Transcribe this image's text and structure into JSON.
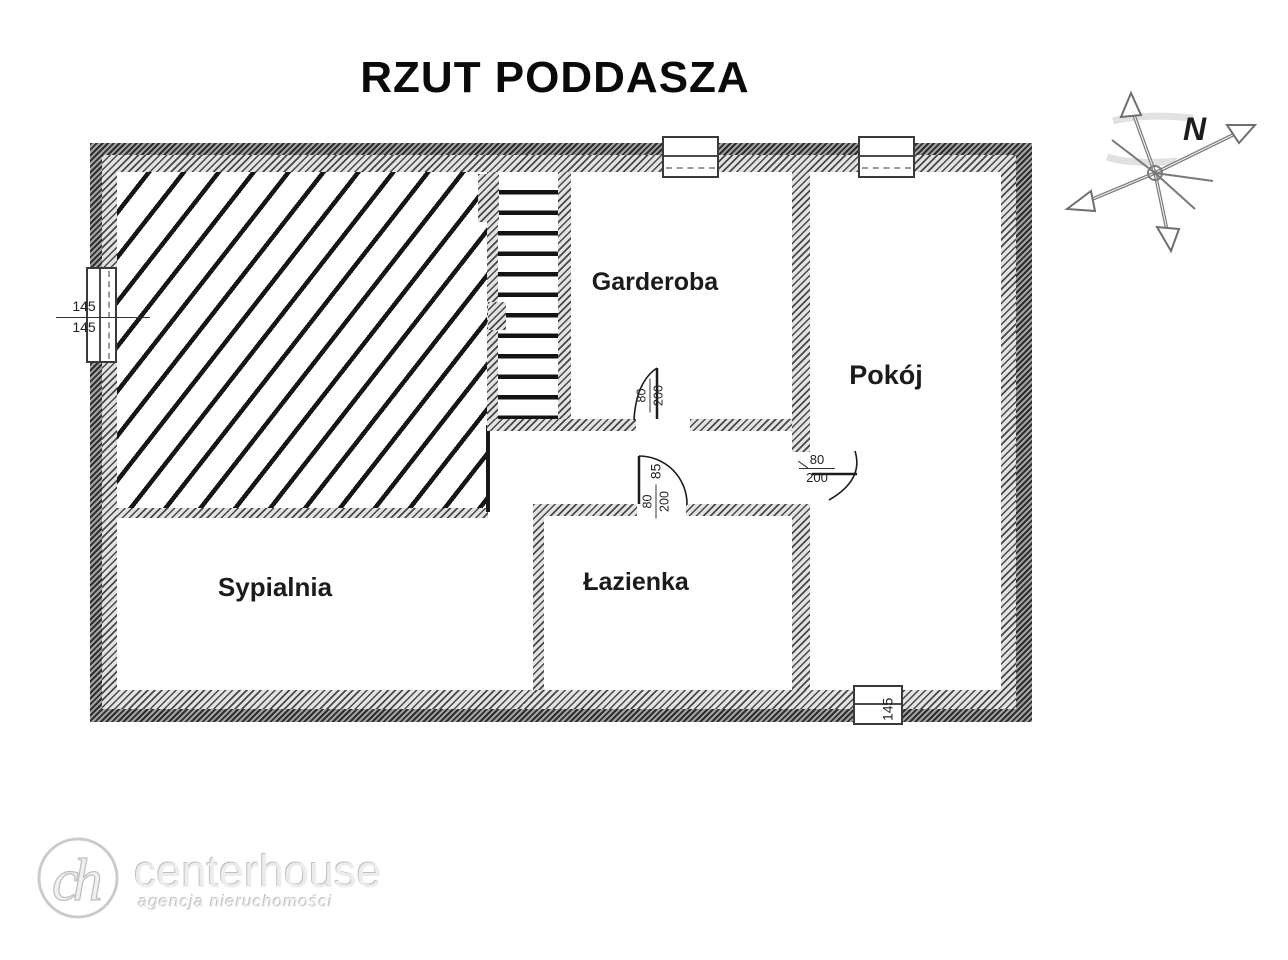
{
  "title": "RZUT PODDASZA",
  "rooms": {
    "garderoba": "Garderoba",
    "pokoj": "Pokój",
    "sypialnia": "Sypialnia",
    "lazienka": "Łazienka"
  },
  "dimensions": {
    "left_window_top": "145",
    "left_window_bottom": "145",
    "bottom_window": "145",
    "garderoba_door_width": "80",
    "garderoba_door_height": "200",
    "lazienka_opening": "85",
    "lazienka_door_width": "80",
    "lazienka_door_height": "200",
    "pokoj_door_width": "80",
    "pokoj_door_height": "200"
  },
  "compass": {
    "north": "N"
  },
  "watermark": {
    "monogram": "ch",
    "brand": "centerhouse",
    "tagline": "agencja nieruchomości"
  },
  "colors": {
    "ink": "#111111",
    "watermark": "#d6d6d6"
  }
}
